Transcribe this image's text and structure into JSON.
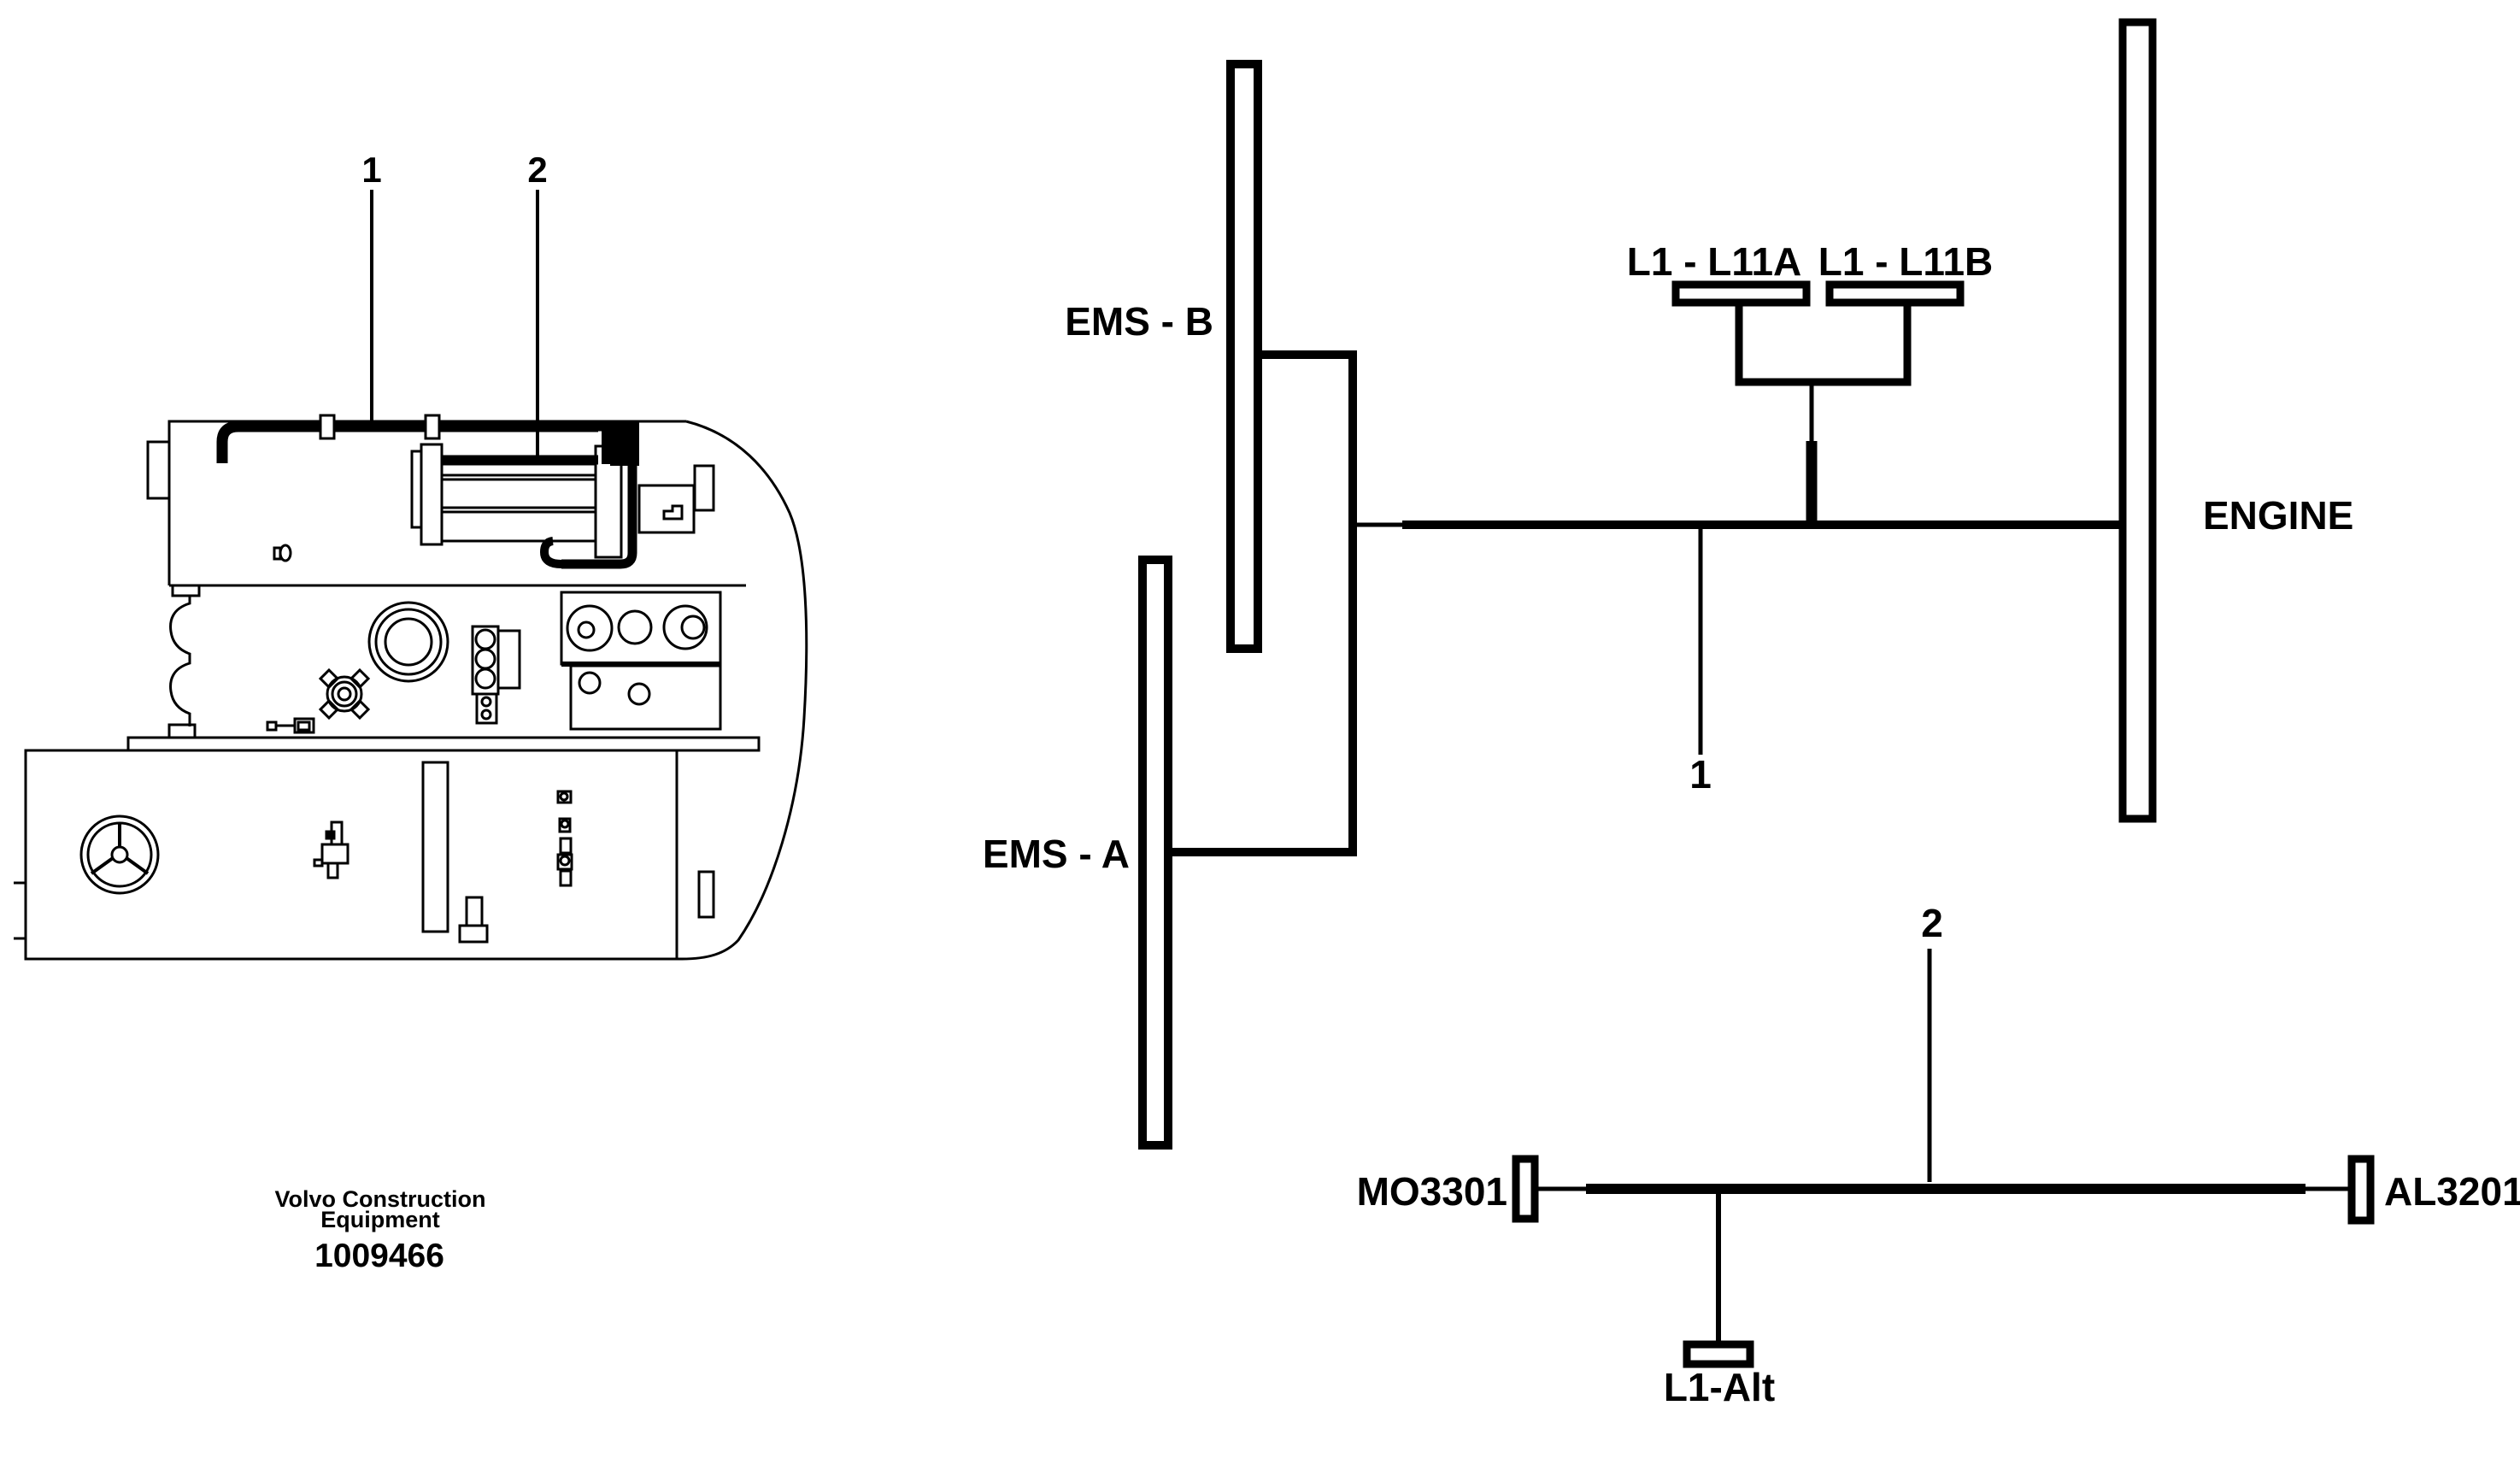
{
  "colors": {
    "ink": "#000000",
    "paper": "#ffffff"
  },
  "machine_inset": {
    "callout_1": "1",
    "callout_2": "2",
    "caption_line1": "Volvo Construction",
    "caption_line2": "Equipment",
    "part_number": "1009466"
  },
  "schematic": {
    "cable_1_label": "1",
    "cable_2_label": "2",
    "ems_b": "EMS - B",
    "ems_a": "EMS - A",
    "engine": "ENGINE",
    "l1_l11a": "L1 - L11A",
    "l1_l11b": "L1 - L11B",
    "mo3301": "MO3301",
    "al3201": "AL3201",
    "l1_alt": "L1-Alt"
  }
}
